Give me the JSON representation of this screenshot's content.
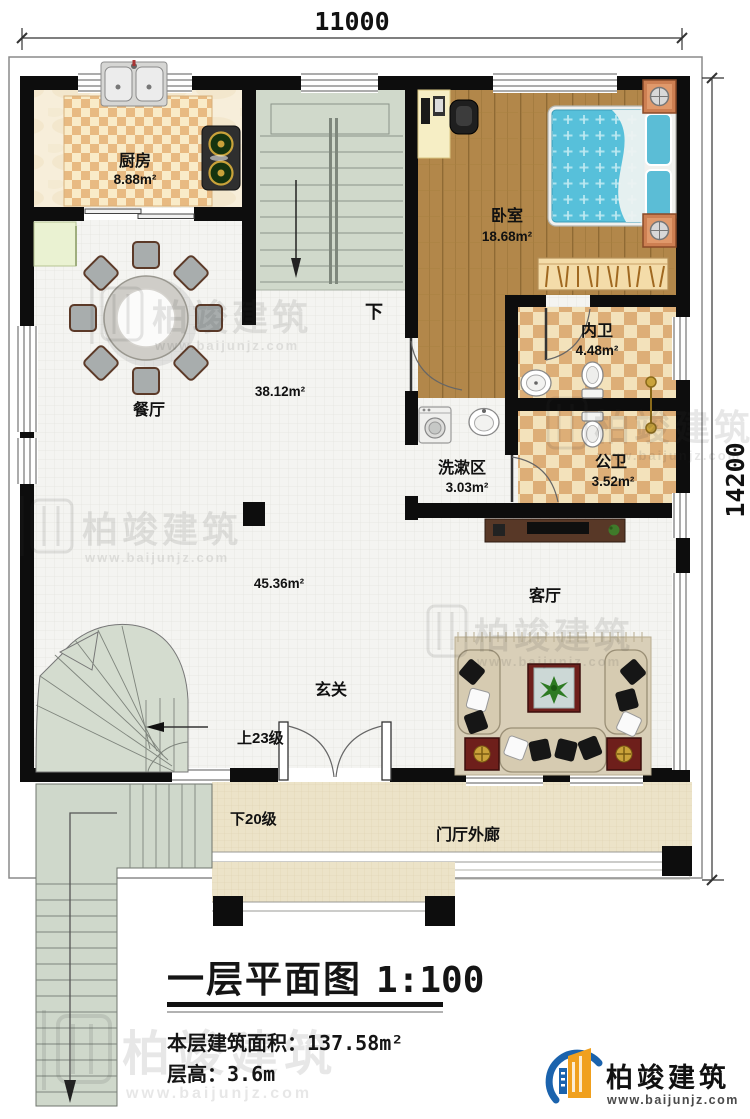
{
  "dimensions": {
    "top": "11000",
    "right": "14200"
  },
  "rooms": {
    "kitchen": {
      "name": "厨房",
      "area": "8.88m²"
    },
    "dining": {
      "name": "餐厅",
      "area": "38.12m²"
    },
    "bedroom": {
      "name": "卧室",
      "area": "18.68m²"
    },
    "ensuite": {
      "name": "内卫",
      "area": "4.48m²"
    },
    "wash": {
      "name": "洗漱区",
      "area": "3.03m²"
    },
    "bath": {
      "name": "公卫",
      "area": "3.52m²"
    },
    "living": {
      "name": "客厅",
      "area": "45.36m²"
    },
    "foyer": {
      "name": "玄关"
    },
    "porch": {
      "name": "门厅外廊"
    }
  },
  "stairs": {
    "inner_down": "下",
    "up": "上23级",
    "down": "下20级"
  },
  "titleblock": {
    "title": "一层平面图",
    "scale": "1:100",
    "area_label": "本层建筑面积：",
    "area_value": "137.58m²",
    "height_label": "层高：",
    "height_value": "3.6m"
  },
  "watermark": {
    "brand": "柏竣建筑",
    "url": "www.baijunjz.com",
    "icon": "baijun-building-logo"
  },
  "logo": {
    "brand": "柏竣建筑",
    "url": "www.baijunjz.com",
    "icon": "baijun-building-logo"
  },
  "colors": {
    "wall": "#0d0d0d",
    "wood_floor": "#b2874a",
    "bath_checker_light": "#f3e2bb",
    "bath_checker_dark": "#ddae77",
    "stair_green": "#d0d9cb",
    "porch_tile": "#ece3c8",
    "bed_blue": "#57c0da",
    "logo_blue": "#1b63ad",
    "logo_orange": "#f0a01e"
  }
}
